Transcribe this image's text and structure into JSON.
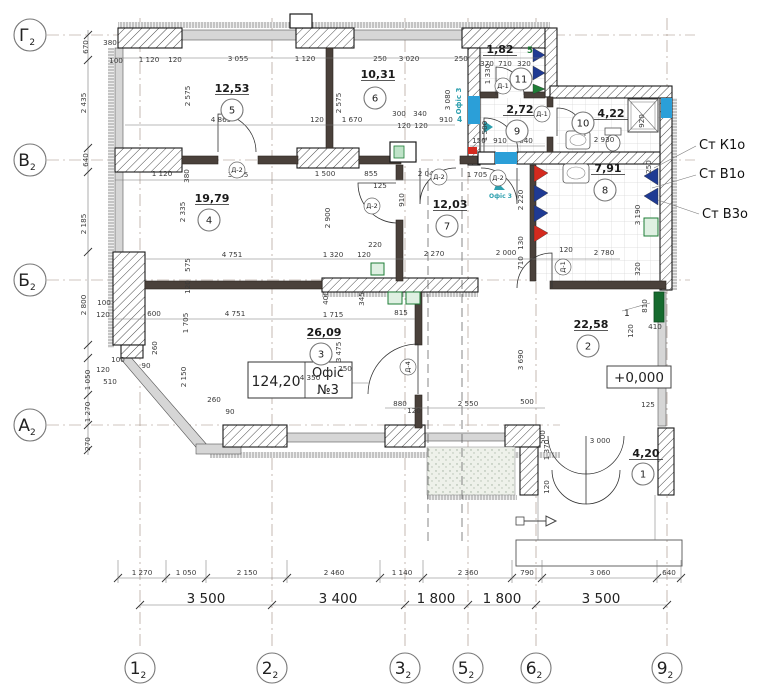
{
  "drawing": {
    "axes": {
      "left": [
        {
          "name": "Г",
          "sub": "2",
          "y": 35
        },
        {
          "name": "В",
          "sub": "2",
          "y": 160
        },
        {
          "name": "Б",
          "sub": "2",
          "y": 280
        },
        {
          "name": "А",
          "sub": "2",
          "y": 425
        }
      ],
      "bottom": [
        {
          "name": "1",
          "sub": "2",
          "x": 140
        },
        {
          "name": "2",
          "sub": "2",
          "x": 272
        },
        {
          "name": "3",
          "sub": "2",
          "x": 405
        },
        {
          "name": "5",
          "sub": "2",
          "x": 468
        },
        {
          "name": "6",
          "sub": "2",
          "x": 536
        },
        {
          "name": "9",
          "sub": "2",
          "x": 667
        }
      ]
    },
    "rooms": [
      {
        "n": "5",
        "a": "12,53",
        "x": 232,
        "y": 110,
        "ax": 232,
        "ay": 92
      },
      {
        "n": "6",
        "a": "10,31",
        "x": 375,
        "y": 98,
        "ax": 378,
        "ay": 78
      },
      {
        "n": "11",
        "a": "1,82",
        "x": 521,
        "y": 79,
        "ax": 500,
        "ay": 53
      },
      {
        "n": "9",
        "a": "2,72",
        "x": 517,
        "y": 131,
        "ax": 520,
        "ay": 113
      },
      {
        "n": "10",
        "a": "4,22",
        "x": 583,
        "y": 123,
        "ax": 611,
        "ay": 117
      },
      {
        "n": "4",
        "a": "19,79",
        "x": 209,
        "y": 220,
        "ax": 212,
        "ay": 202
      },
      {
        "n": "7",
        "a": "12,03",
        "x": 447,
        "y": 226,
        "ax": 450,
        "ay": 208
      },
      {
        "n": "8",
        "a": "7,91",
        "x": 605,
        "y": 190,
        "ax": 608,
        "ay": 172
      },
      {
        "n": "3",
        "a": "26,09",
        "x": 321,
        "y": 354,
        "ax": 324,
        "ay": 336
      },
      {
        "n": "2",
        "a": "22,58",
        "x": 588,
        "y": 346,
        "ax": 591,
        "ay": 328
      },
      {
        "n": "1",
        "a": "4,20",
        "x": 643,
        "y": 474,
        "ax": 646,
        "ay": 457
      }
    ],
    "door_tags": [
      {
        "t": "Д-2",
        "x": 237,
        "y": 170
      },
      {
        "t": "Д-2",
        "x": 372,
        "y": 206
      },
      {
        "t": "Д-2",
        "x": 439,
        "y": 177
      },
      {
        "t": "Д-2",
        "x": 498,
        "y": 178
      },
      {
        "t": "Д-1",
        "x": 503,
        "y": 86
      },
      {
        "t": "Д-1",
        "x": 542,
        "y": 114
      },
      {
        "t": "Д-1",
        "x": 563,
        "y": 267,
        "r": 1
      },
      {
        "t": "Д-4",
        "x": 408,
        "y": 367,
        "r": 1
      }
    ],
    "risers": [
      {
        "t": "Ст К1о",
        "x": 699,
        "y": 149
      },
      {
        "t": "Ст В1о",
        "x": 699,
        "y": 178
      },
      {
        "t": "Ст В3о",
        "x": 702,
        "y": 218
      }
    ],
    "labels": {
      "office_area": "124,20",
      "office_name1": "Офіс",
      "office_name2": "№3",
      "elevation": "+0,000",
      "green_5": "5",
      "teal_4": "4",
      "window_tag": "Офіс 3",
      "window_tag2": "Офіс 3",
      "vent_1": "1"
    },
    "colors": {
      "blue": "#2b9fd8",
      "red": "#d42a1e",
      "navy": "#1f3a93",
      "green": "#1e7d36",
      "teal": "#2d9fae"
    },
    "dims": [
      {
        "t": "380",
        "x": 110,
        "y": 45
      },
      {
        "t": "100",
        "x": 116,
        "y": 63
      },
      {
        "t": "1 120",
        "x": 149,
        "y": 62
      },
      {
        "t": "120",
        "x": 175,
        "y": 62
      },
      {
        "t": "3 055",
        "x": 238,
        "y": 61
      },
      {
        "t": "1 120",
        "x": 305,
        "y": 61
      },
      {
        "t": "250",
        "x": 380,
        "y": 61
      },
      {
        "t": "3 020",
        "x": 409,
        "y": 61
      },
      {
        "t": "250",
        "x": 461,
        "y": 61
      },
      {
        "t": "370",
        "x": 487,
        "y": 66
      },
      {
        "t": "710",
        "x": 505,
        "y": 66
      },
      {
        "t": "320",
        "x": 524,
        "y": 66
      },
      {
        "t": "670",
        "x": 88,
        "y": 47,
        "r": 1
      },
      {
        "t": "2 435",
        "x": 86,
        "y": 103,
        "r": 1
      },
      {
        "t": "640",
        "x": 88,
        "y": 160,
        "r": 1
      },
      {
        "t": "2 185",
        "x": 86,
        "y": 224,
        "r": 1
      },
      {
        "t": "2 800",
        "x": 86,
        "y": 305,
        "r": 1
      },
      {
        "t": "1 050",
        "x": 90,
        "y": 380,
        "r": 1
      },
      {
        "t": "1 270",
        "x": 90,
        "y": 412,
        "r": 1
      },
      {
        "t": "270",
        "x": 90,
        "y": 444,
        "r": 1
      },
      {
        "t": "2 575",
        "x": 190,
        "y": 96,
        "r": 1
      },
      {
        "t": "2 575",
        "x": 341,
        "y": 103,
        "r": 1
      },
      {
        "t": "4 865",
        "x": 221,
        "y": 122
      },
      {
        "t": "120",
        "x": 317,
        "y": 122
      },
      {
        "t": "1 670",
        "x": 352,
        "y": 122
      },
      {
        "t": "300",
        "x": 399,
        "y": 116
      },
      {
        "t": "340",
        "x": 420,
        "y": 116
      },
      {
        "t": "120",
        "x": 404,
        "y": 128
      },
      {
        "t": "120",
        "x": 421,
        "y": 128
      },
      {
        "t": "910",
        "x": 446,
        "y": 122
      },
      {
        "t": "3 080",
        "x": 450,
        "y": 100,
        "r": 1
      },
      {
        "t": "1 330",
        "x": 490,
        "y": 74,
        "r": 1
      },
      {
        "t": "1 500",
        "x": 487,
        "y": 131,
        "r": 1
      },
      {
        "t": "150",
        "x": 479,
        "y": 143
      },
      {
        "t": "910",
        "x": 500,
        "y": 143
      },
      {
        "t": "840",
        "x": 526,
        "y": 143
      },
      {
        "t": "2 930",
        "x": 604,
        "y": 142
      },
      {
        "t": "920",
        "x": 644,
        "y": 121,
        "r": 1
      },
      {
        "t": "1 120",
        "x": 162,
        "y": 176
      },
      {
        "t": "380",
        "x": 189,
        "y": 176,
        "r": 1
      },
      {
        "t": "3 065",
        "x": 238,
        "y": 177
      },
      {
        "t": "1 500",
        "x": 325,
        "y": 176
      },
      {
        "t": "855",
        "x": 371,
        "y": 176
      },
      {
        "t": "125",
        "x": 380,
        "y": 188
      },
      {
        "t": "2 045",
        "x": 428,
        "y": 176
      },
      {
        "t": "1 705",
        "x": 477,
        "y": 177
      },
      {
        "t": "2 335",
        "x": 185,
        "y": 212,
        "r": 1
      },
      {
        "t": "2 900",
        "x": 330,
        "y": 218,
        "r": 1
      },
      {
        "t": "910",
        "x": 404,
        "y": 200,
        "r": 1
      },
      {
        "t": "2 220",
        "x": 523,
        "y": 200,
        "r": 1
      },
      {
        "t": "130",
        "x": 523,
        "y": 243,
        "r": 1
      },
      {
        "t": "710",
        "x": 523,
        "y": 263,
        "r": 1
      },
      {
        "t": "4 751",
        "x": 232,
        "y": 257
      },
      {
        "t": "1 320",
        "x": 333,
        "y": 257
      },
      {
        "t": "120",
        "x": 364,
        "y": 257
      },
      {
        "t": "220",
        "x": 375,
        "y": 247
      },
      {
        "t": "575",
        "x": 190,
        "y": 265,
        "r": 1
      },
      {
        "t": "120",
        "x": 190,
        "y": 287,
        "r": 1
      },
      {
        "t": "2 270",
        "x": 434,
        "y": 256
      },
      {
        "t": "2 000",
        "x": 506,
        "y": 255
      },
      {
        "t": "120",
        "x": 566,
        "y": 252
      },
      {
        "t": "2 780",
        "x": 604,
        "y": 255
      },
      {
        "t": "3 190",
        "x": 640,
        "y": 215,
        "r": 1
      },
      {
        "t": "320",
        "x": 640,
        "y": 269,
        "r": 1
      },
      {
        "t": "250",
        "x": 651,
        "y": 167,
        "r": 1
      },
      {
        "t": "600",
        "x": 154,
        "y": 316
      },
      {
        "t": "4 751",
        "x": 235,
        "y": 316
      },
      {
        "t": "1 715",
        "x": 333,
        "y": 317
      },
      {
        "t": "815",
        "x": 401,
        "y": 315
      },
      {
        "t": "400",
        "x": 328,
        "y": 298,
        "r": 1
      },
      {
        "t": "345",
        "x": 364,
        "y": 299,
        "r": 1
      },
      {
        "t": "1 705",
        "x": 188,
        "y": 323,
        "r": 1
      },
      {
        "t": "2 150",
        "x": 186,
        "y": 377,
        "r": 1
      },
      {
        "t": "3 475",
        "x": 341,
        "y": 352,
        "r": 1
      },
      {
        "t": "3 690",
        "x": 523,
        "y": 360,
        "r": 1
      },
      {
        "t": "810",
        "x": 647,
        "y": 306,
        "r": 1
      },
      {
        "t": "120",
        "x": 633,
        "y": 331,
        "r": 1
      },
      {
        "t": "410",
        "x": 655,
        "y": 329
      },
      {
        "t": "100",
        "x": 104,
        "y": 305
      },
      {
        "t": "120",
        "x": 103,
        "y": 317
      },
      {
        "t": "100",
        "x": 118,
        "y": 362
      },
      {
        "t": "90",
        "x": 146,
        "y": 368
      },
      {
        "t": "120",
        "x": 103,
        "y": 372
      },
      {
        "t": "510",
        "x": 110,
        "y": 384
      },
      {
        "t": "260",
        "x": 157,
        "y": 348,
        "r": 1
      },
      {
        "t": "260",
        "x": 214,
        "y": 402
      },
      {
        "t": "90",
        "x": 230,
        "y": 414
      },
      {
        "t": "250",
        "x": 345,
        "y": 371
      },
      {
        "t": "4 350",
        "x": 310,
        "y": 380
      },
      {
        "t": "880",
        "x": 400,
        "y": 406
      },
      {
        "t": "120",
        "x": 414,
        "y": 413
      },
      {
        "t": "2 550",
        "x": 468,
        "y": 406
      },
      {
        "t": "500",
        "x": 527,
        "y": 404
      },
      {
        "t": "3 000",
        "x": 600,
        "y": 443
      },
      {
        "t": "125",
        "x": 648,
        "y": 407
      },
      {
        "t": "1 370",
        "x": 549,
        "y": 450,
        "r": 1
      },
      {
        "t": "120",
        "x": 549,
        "y": 487,
        "r": 1
      },
      {
        "t": "500",
        "x": 545,
        "y": 437,
        "r": 1
      },
      {
        "t": "1 270",
        "x": 142,
        "y": 575
      },
      {
        "t": "1 050",
        "x": 186,
        "y": 575
      },
      {
        "t": "2 150",
        "x": 247,
        "y": 575
      },
      {
        "t": "2 460",
        "x": 334,
        "y": 575
      },
      {
        "t": "1 140",
        "x": 402,
        "y": 575
      },
      {
        "t": "2 360",
        "x": 468,
        "y": 575
      },
      {
        "t": "790",
        "x": 527,
        "y": 575
      },
      {
        "t": "3 060",
        "x": 600,
        "y": 575
      },
      {
        "t": "640",
        "x": 669,
        "y": 575
      },
      {
        "t": "3 500",
        "x": 206,
        "y": 603,
        "s": 1
      },
      {
        "t": "3 400",
        "x": 338,
        "y": 603,
        "s": 1
      },
      {
        "t": "1 800",
        "x": 436,
        "y": 603,
        "s": 1
      },
      {
        "t": "1 800",
        "x": 502,
        "y": 603,
        "s": 1
      },
      {
        "t": "3 500",
        "x": 601,
        "y": 603,
        "s": 1
      }
    ]
  }
}
